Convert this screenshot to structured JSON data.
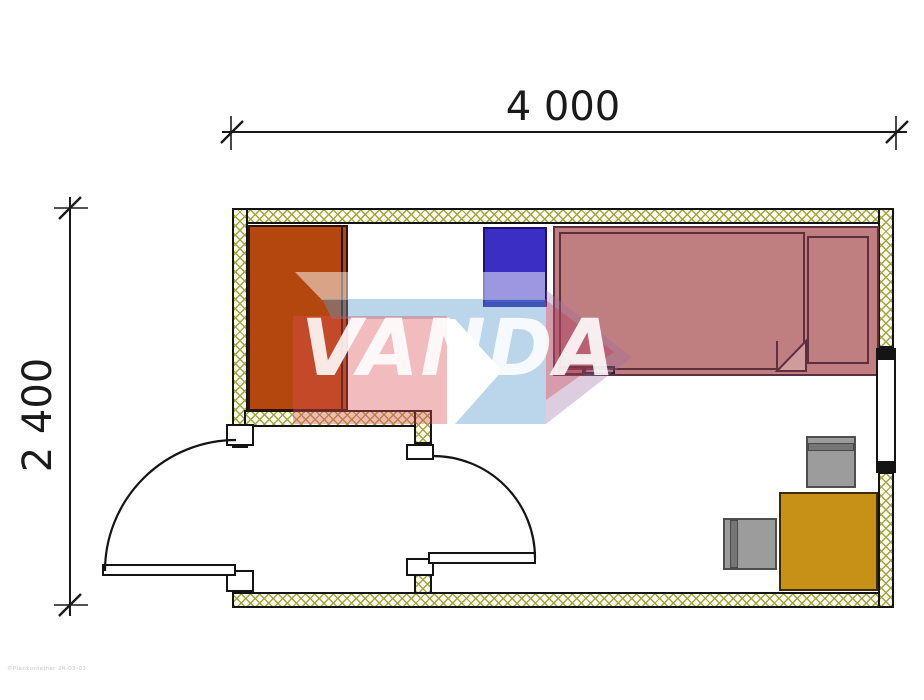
{
  "dimensions": {
    "width_label": "4 000",
    "height_label": "2 400"
  },
  "watermark": {
    "text": "VANDA",
    "footer_code": "©Plankontejner 2R-03-03"
  },
  "colors": {
    "wall_hatch": "#a0a542",
    "wall_hatch_bg": "#fcfcef",
    "outline": "#141414",
    "wardrobe": "#b3470e",
    "cabinet_blue": "#3b2ec5",
    "bed_pink": "#bf7f80",
    "bed_outline": "#5f2f3f",
    "blanket_fold": "#cf9b9c",
    "desk_gold": "#c79016",
    "chair_gray": "#9c9c9c",
    "chair_band": "#767676",
    "watermark_blue": "#5c9ccc",
    "watermark_pink": "#de4d54",
    "watermark_red": "#c82838",
    "watermark_text": "#ffffff",
    "dimension_text": "#1a1a1a"
  },
  "furniture": [
    {
      "name": "wardrobe"
    },
    {
      "name": "cabinet"
    },
    {
      "name": "bed"
    },
    {
      "name": "pillow"
    },
    {
      "name": "blanket"
    },
    {
      "name": "desk"
    },
    {
      "name": "chair-top"
    },
    {
      "name": "chair-left"
    }
  ]
}
